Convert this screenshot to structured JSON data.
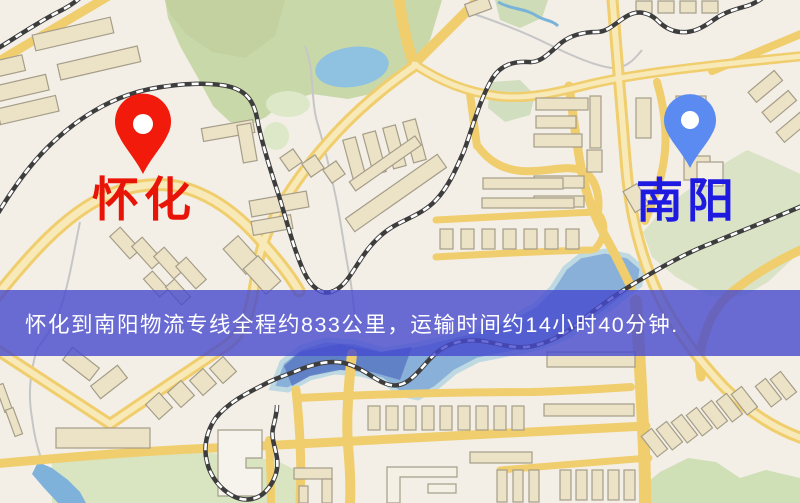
{
  "map": {
    "origin": {
      "label": "怀化",
      "pin_color": "#f21a0a",
      "label_color": "#e91408"
    },
    "destination": {
      "label": "南阳",
      "pin_color": "#5b8bf0",
      "label_color": "#1f1ae0"
    }
  },
  "banner": {
    "text": "怀化到南阳物流专线全程约833公里，运输时间约14小时40分钟.",
    "distance_text": "约833公里",
    "duration_text": "约14小时40分钟",
    "background_color": "#4a4ace",
    "text_color": "#ffffff"
  },
  "palette": {
    "map_background": "#f3efe6",
    "road_yellow": "#f0cd6d",
    "railway_dark": "#3d3d3d",
    "park_green": "#c9d8a9",
    "water_blue": "#84add8",
    "building_fill": "#ece3c7"
  }
}
